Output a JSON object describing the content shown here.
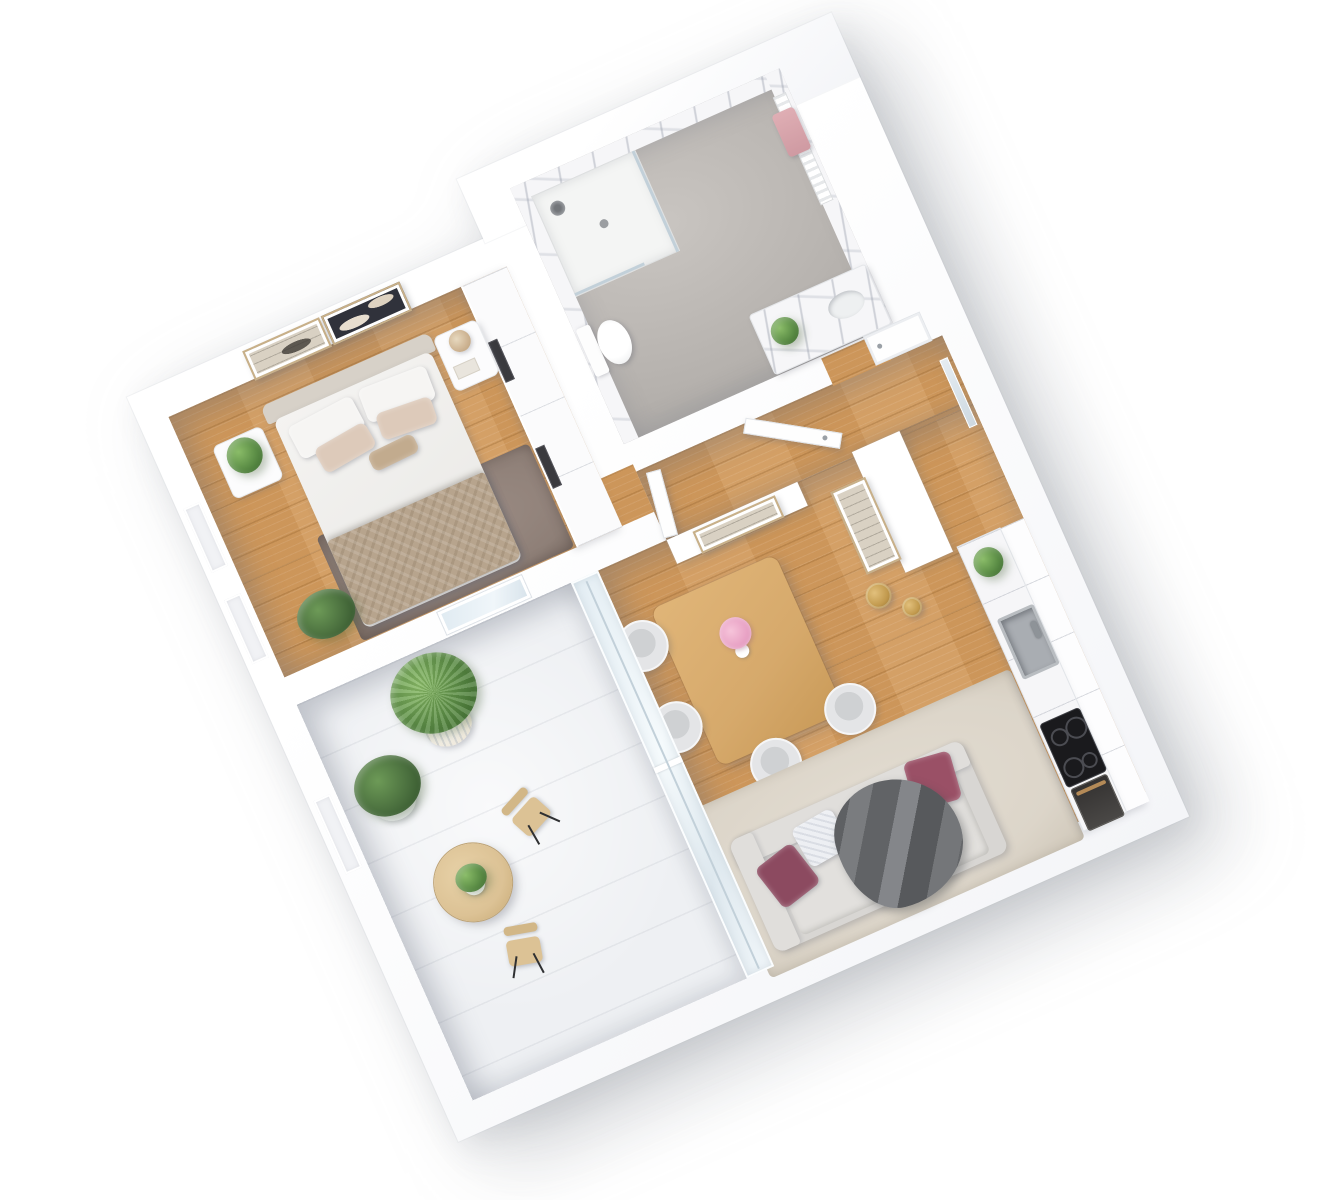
{
  "scene": {
    "title": "3D rendered one-bedroom apartment floor plan, top-down isometric view",
    "style": "photorealistic architectural dollhouse render on white background",
    "rotation_deg": -24,
    "visible_text": ""
  },
  "palette": {
    "wall-white": "#ffffff",
    "wood-floor": "#d29b5e",
    "concrete-light": "#c9c5c1",
    "concrete-dark": "#b2aeaa",
    "marble-base": "#f6f6f8",
    "balcony-floor": "#eef0f3",
    "rug-bedroom": "#8e7f77",
    "rug-living": "#dcd5c9",
    "sofa-body": "#d8d6d3",
    "sofa-cushion": "#e2e0dd",
    "pillow-magenta": "#9a5066",
    "pillow-magenta-dark": "#8c4a60",
    "pillow-white": "#edeff3",
    "throw-gray": "#66686b",
    "table-wood": "#d6a96b",
    "chair-shell": "#e4e5e7",
    "chair-seat": "#cfd1d3",
    "gold": "#c29a4e",
    "headboard": "#d7d1c8",
    "duvet": "#f4f3f1",
    "blanket": "#b7a48d",
    "pillow-blush": "#ddcaba",
    "plant-green": "#5d8f47",
    "plant-light": "#8abc68",
    "plant-dark": "#3c6a2e",
    "fern-green": "#4a6f3e",
    "bistro-wood": "#dcc295",
    "towel-pink": "#dfaeb4",
    "steel": "#b9bdc1",
    "cooktop-black": "#1a1a1d",
    "oven-dark": "#343231",
    "oven-handle": "#b48a57",
    "door-white": "#fefefe",
    "art-dark": "#30323b",
    "art-cream": "#d9d1c3",
    "frame-gold": "#c8b089"
  },
  "rooms": [
    {
      "id": "bedroom",
      "label": "Bedroom",
      "furniture": [
        "double bed with taupe blanket",
        "upholstered headboard",
        "two abstract wall artworks",
        "left nightstand with potted plant",
        "right nightstand with dried flowers and book",
        "taupe area rug",
        "fern plant",
        "built-in white wardrobe"
      ]
    },
    {
      "id": "bathroom",
      "label": "Bathroom",
      "furniture": [
        "walk-in shower with glass panel",
        "rain shower head",
        "toilet",
        "towel radiator with pink towels",
        "vanity with plant",
        "marble walls",
        "concrete floor"
      ]
    },
    {
      "id": "hallway",
      "label": "Hallway / Entry",
      "furniture": [
        "open entrance door",
        "closed front door",
        "framed artwork",
        "bedroom door"
      ]
    },
    {
      "id": "living-dining",
      "label": "Living / Dining room",
      "furniture": [
        "oak dining table with pink flower vase",
        "four gray tub chairs with gold legs",
        "gray sofa",
        "two magenta pillows",
        "white patterned pillow",
        "dark gray throw blanket",
        "beige rug",
        "two gold floor vases",
        "framed artwork on partition"
      ]
    },
    {
      "id": "kitchen",
      "label": "Kitchen",
      "furniture": [
        "white cabinet run with marble countertop",
        "stainless sink with faucet",
        "black induction cooktop",
        "oven with wood handle",
        "upper cabinets",
        "counter plant"
      ]
    },
    {
      "id": "balcony",
      "label": "Balcony",
      "furniture": [
        "round bistro table with plant",
        "two beige folding chairs",
        "bush in ribbed planter",
        "fern in white pot",
        "glass sliding door",
        "window to bedroom"
      ]
    }
  ],
  "icons": [
    {
      "name": "shower-head-icon",
      "meaning": "rain shower"
    },
    {
      "name": "cooktop-rings-icon",
      "meaning": "induction burners"
    }
  ]
}
